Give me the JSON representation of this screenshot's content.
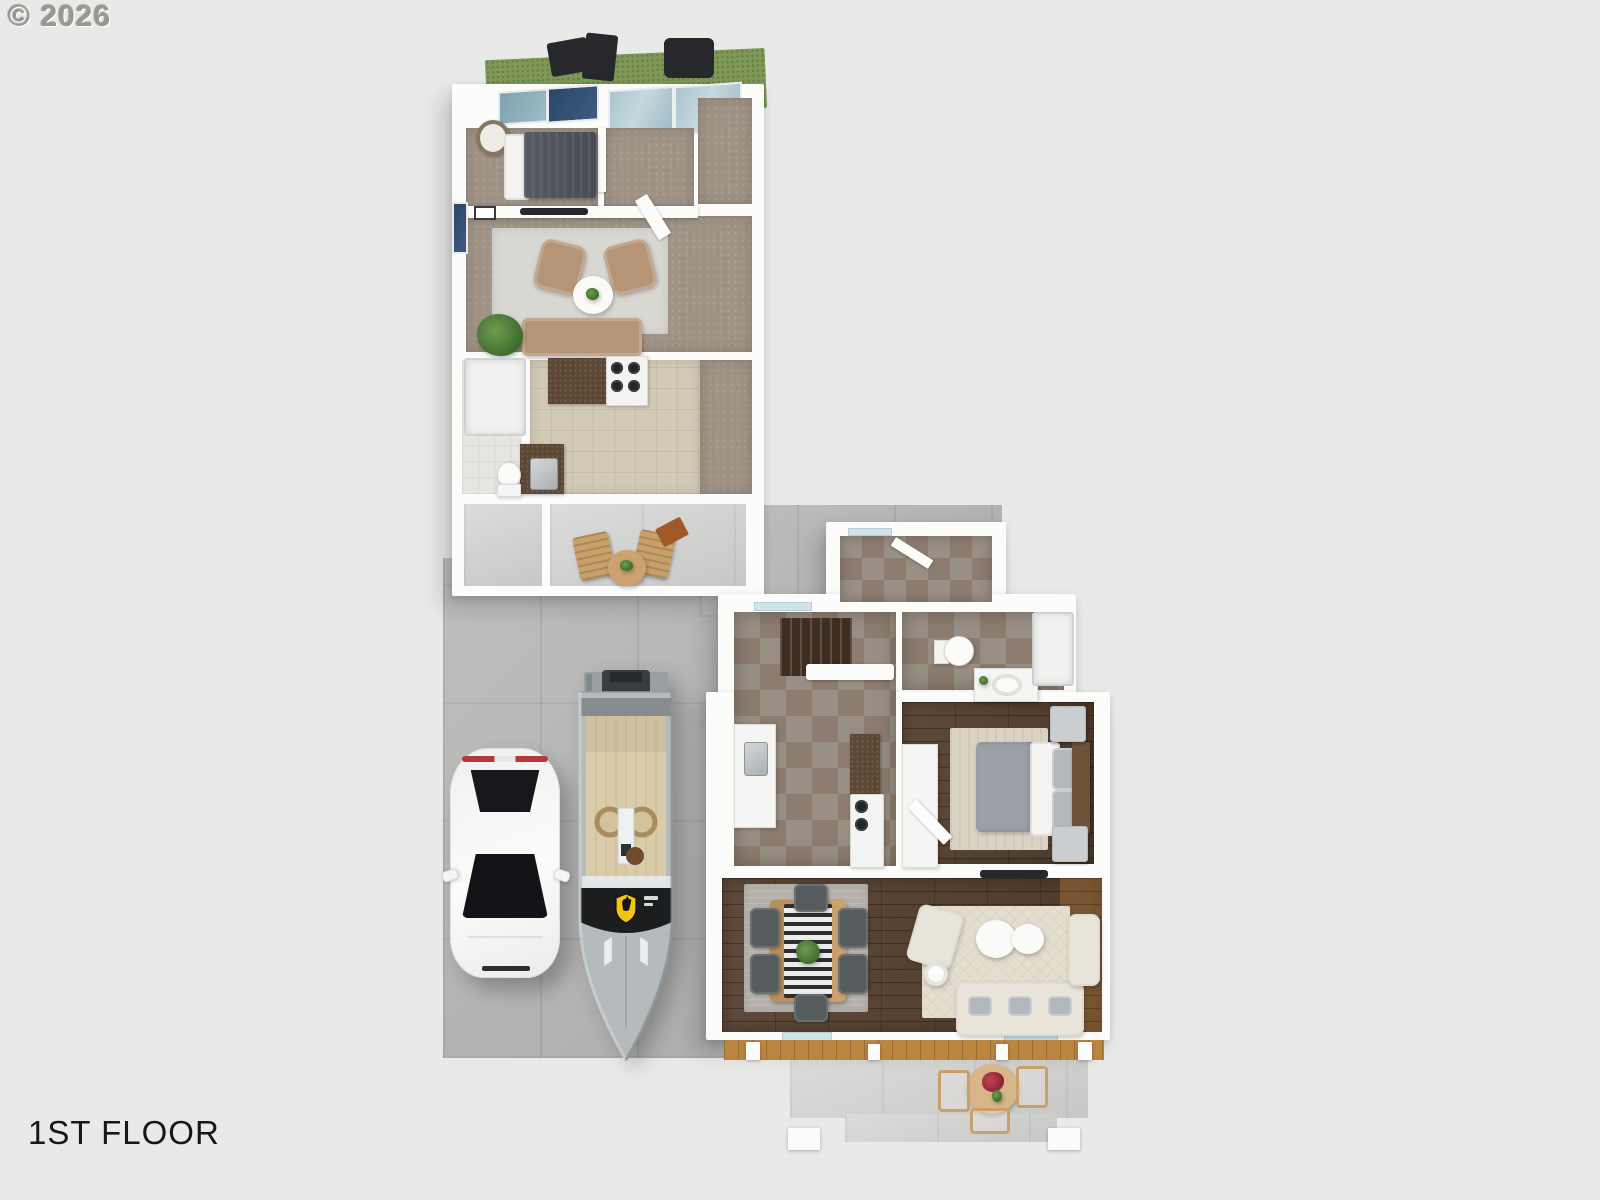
{
  "watermark": {
    "text": "© 2026"
  },
  "floor_label": {
    "text": "1ST FLOOR"
  },
  "scene": {
    "description": "3D dollhouse-style first-floor plan render of a property with a main house, an accessory unit, a driveway with a parked car and a speedboat",
    "background_color": "#e9e9e7",
    "units": [
      {
        "id": "adu",
        "rooms": [
          "roof-deck",
          "bedroom",
          "hallway",
          "closet",
          "living-room",
          "kitchen",
          "bathroom",
          "storage",
          "patio"
        ]
      },
      {
        "id": "main-house",
        "rooms": [
          "mudroom",
          "entry-hall",
          "staircase",
          "bathroom",
          "bedroom",
          "kitchen",
          "dining-room",
          "living-room",
          "front-porch",
          "front-patio"
        ]
      }
    ],
    "vehicles": [
      {
        "id": "car",
        "type": "sedan-top-view",
        "color": "#f6f6f4"
      },
      {
        "id": "boat",
        "type": "speedboat",
        "color": "#b5babc",
        "badge": "ferrari-shield",
        "badge_color": "#f3c512"
      }
    ],
    "palette": {
      "driveway_concrete": "#b7b7b5",
      "patio_concrete": "#d2d2d0",
      "walls": "#fcfcfb",
      "wood_floor": "#55402f",
      "checker_tile_a": "#8c7c6f",
      "checker_tile_b": "#988e83",
      "carpet": "#a09386",
      "kitchen_tile": "#d3c9b7",
      "green_roof": "#7e9957",
      "window_glass": "#a9c4ce",
      "sofa_tan": "#b69577",
      "sofa_cream": "#e9e4d9",
      "bed_gray": "#9ba1a7",
      "bed_navy": "#4c515a",
      "rug_cream": "#e4decf",
      "rug_gray": "#b6b2ab",
      "taillight_red": "#b23a3c",
      "ferrari_yellow": "#f3c512"
    }
  }
}
